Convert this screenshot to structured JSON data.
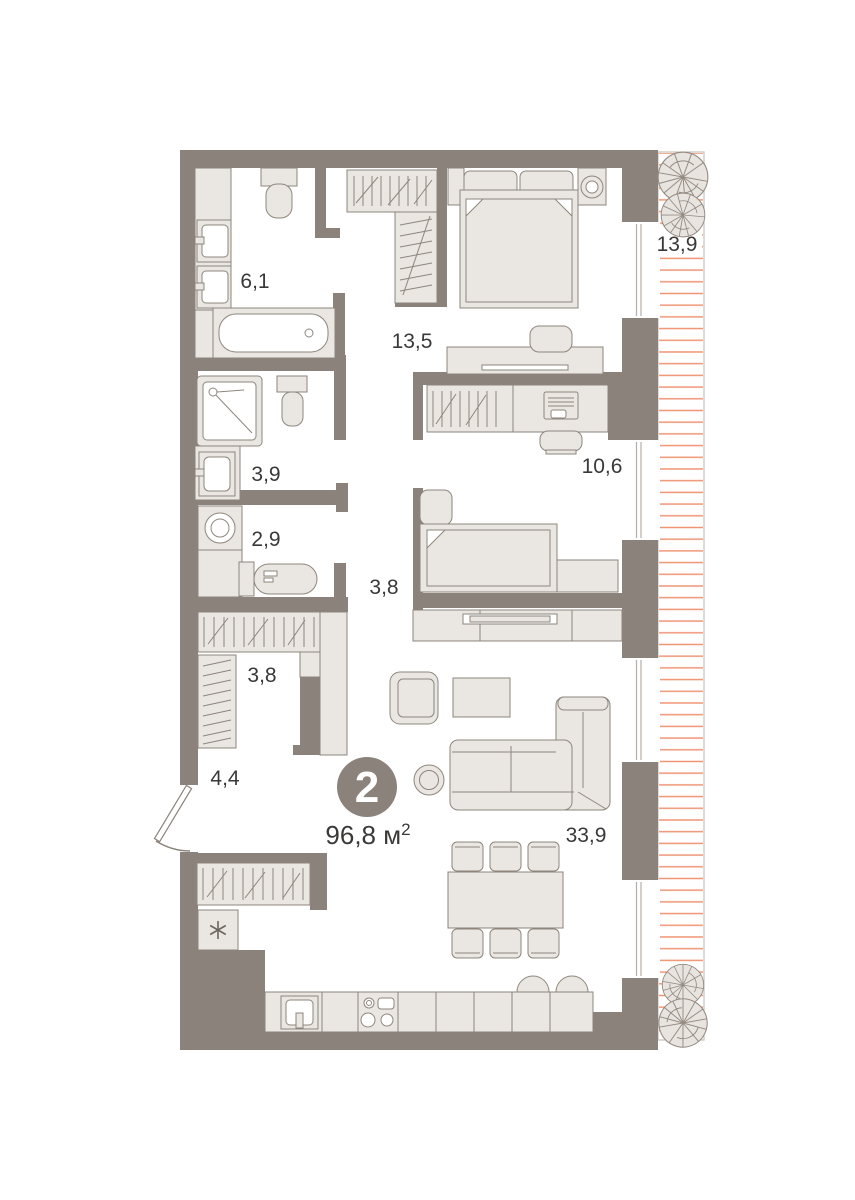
{
  "floor_plan": {
    "badge": {
      "rooms_count": "2",
      "area_main": "96,8 м",
      "area_sup": "2"
    },
    "labels": {
      "bathroom": "6,1",
      "bedroom": "13,5",
      "balcony": "13,9",
      "shower_room": "3,9",
      "wc": "2,9",
      "corridor": "3,8",
      "wardrobe": "3,8",
      "hallway": "4,4",
      "bedroom_2": "10,6",
      "living_kitchen": "33,9"
    },
    "colors": {
      "wall": "#8B837B",
      "furniture_fill": "#EAE6E2",
      "furniture_stroke": "#8E867D",
      "balcony_hatch": "#EF9371",
      "balcony_border": "#C8C2BB",
      "label_text": "#3A3938",
      "badge_background": "#8B837B",
      "badge_text": "#FFFFFF"
    }
  }
}
